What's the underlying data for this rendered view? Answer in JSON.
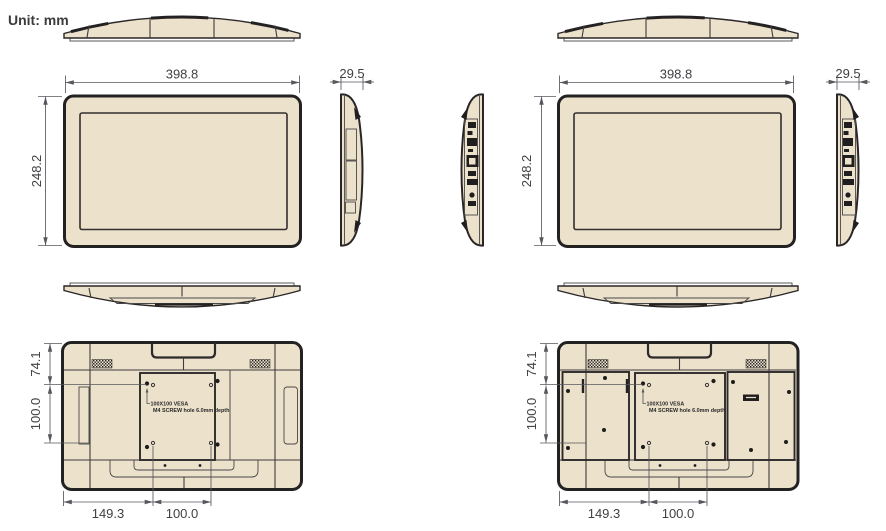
{
  "unit_label": "Unit: mm",
  "colors": {
    "body_fill": "#ECE1CB",
    "outline": "#242122",
    "dimension_lines": "#56575C",
    "dimension_text": "#414044",
    "background": "#FFFFFF"
  },
  "sets": [
    {
      "width_mm": "398.8",
      "height_mm": "248.2",
      "depth_mm": "29.5",
      "vesa_offset_top_mm": "74.1",
      "vesa_spacing_vertical_mm": "100.0",
      "vesa_offset_left_mm": "149.3",
      "vesa_spacing_horizontal_mm": "100.0",
      "vesa_note_line1": "100X100 VESA",
      "vesa_note_line2": "M4 SCREW hole 6.0mm depth"
    },
    {
      "width_mm": "398.8",
      "height_mm": "248.2",
      "depth_mm": "29.5",
      "vesa_offset_top_mm": "74.1",
      "vesa_spacing_vertical_mm": "100.0",
      "vesa_offset_left_mm": "149.3",
      "vesa_spacing_horizontal_mm": "100.0",
      "vesa_note_line1": "100X100 VESA",
      "vesa_note_line2": "M4 SCREW hole 6.0mm depth"
    }
  ]
}
